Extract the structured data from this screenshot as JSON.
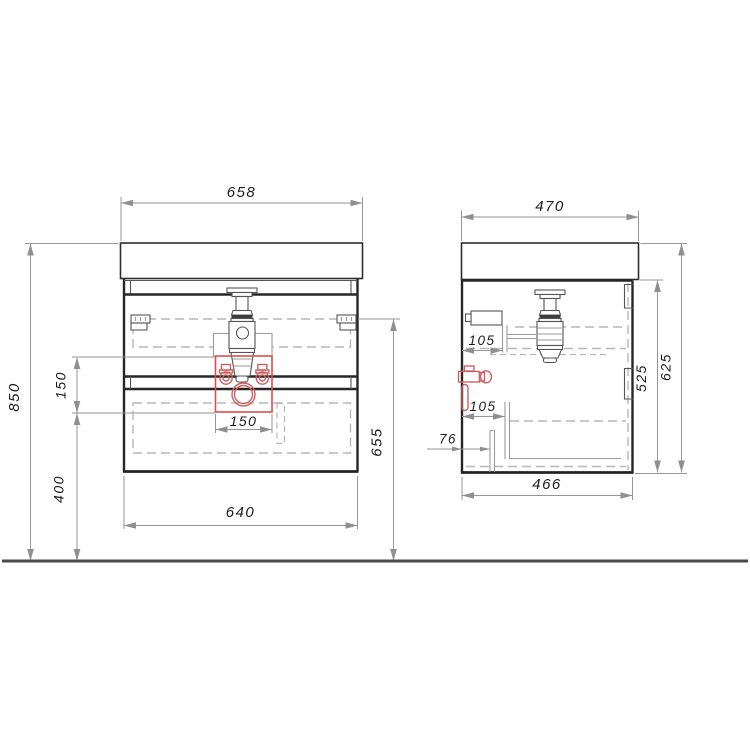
{
  "drawing": {
    "type": "furniture technical drawing - wall-hung vanity cabinet, front and side views with mounting dimensions",
    "views": [
      "front-view",
      "side-view"
    ],
    "colors": {
      "line_dark": "#2e2e2e",
      "hidden_line": "#b7b7b7",
      "dimension_line": "#969696",
      "highlight_red": "#d84f4f",
      "floor_line": "#4a4a4a"
    }
  },
  "dims": {
    "front_width_top": "658",
    "front_total_height": "850",
    "front_valve_zone_height": "150",
    "front_bottom_clearance": "400",
    "front_valve_zone_width": "150",
    "front_cabinet_width": "640",
    "front_mount_height": "655",
    "side_top_depth": "470",
    "side_inlet_offset_upper": "105",
    "side_inlet_offset_lower": "105",
    "side_drain_offset": "76",
    "side_cabinet_depth": "466",
    "side_cabinet_height": "525",
    "side_total_height": "625"
  }
}
